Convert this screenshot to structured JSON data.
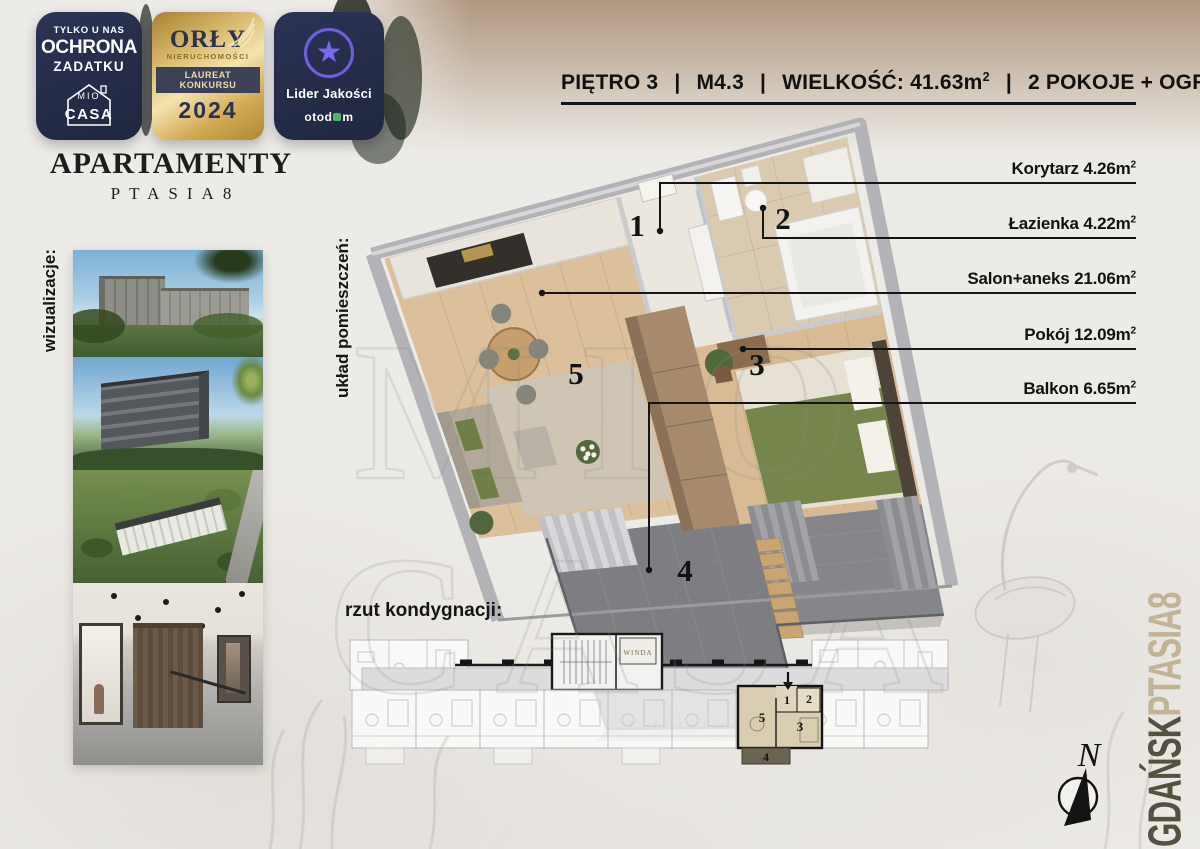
{
  "badges": {
    "protection": {
      "line1": "TYLKO U NAS",
      "line2": "OCHRONA",
      "line3": "ZADATKU",
      "logo_mio": "MIO",
      "logo_casa": "CASA"
    },
    "orly": {
      "name": "ORŁY",
      "category": "NIERUCHOMOŚCI",
      "award": "LAUREAT KONKURSU",
      "year": "2024"
    },
    "otodom": {
      "award": "Lider Jakości",
      "brand_start": "otod",
      "brand_end": "m",
      "star": "★"
    }
  },
  "brand": {
    "name": "APARTAMENTY",
    "project": "PTASIA8"
  },
  "section_labels": {
    "visualizations": "wizualizacje:",
    "room_layout": "układ pomieszczeń:",
    "floor_plan": "rzut kondygnacji:"
  },
  "header": {
    "floor": "PIĘTRO 3",
    "unit": "M4.3",
    "size": "WIELKOŚĆ: 41.63m",
    "size_sup": "2",
    "rooms": "2 POKOJE + OGRÓD",
    "divider": "|"
  },
  "rooms": [
    {
      "number": "1",
      "label": "Korytarz 4.26m",
      "sup": "2"
    },
    {
      "number": "2",
      "label": "Łazienka 4.22m",
      "sup": "2"
    },
    {
      "number": "5",
      "label": "Salon+aneks 21.06m",
      "sup": "2"
    },
    {
      "number": "3",
      "label": "Pokój 12.09m",
      "sup": "2"
    },
    {
      "number": "4",
      "label": "Balkon 6.65m",
      "sup": "2"
    }
  ],
  "plan3d": {
    "numbers": [
      "1",
      "2",
      "3",
      "4",
      "5"
    ]
  },
  "floor_strip": {
    "elevator": "WINDA",
    "unit_numbers": {
      "n1": "1",
      "n2": "2",
      "n3": "3",
      "n4": "4",
      "n5": "5"
    }
  },
  "location": {
    "city": "GDAŃSK",
    "project": "PTASIA8"
  },
  "compass": {
    "north": "N"
  },
  "watermark": {
    "line1": "MIO",
    "line2": "CASA"
  },
  "colors": {
    "navy": "#252e4c",
    "gold": "#c9a14e",
    "purple": "#7b68ee",
    "otodom_green": "#4db56a",
    "highlight_unit": "#d9cdb2",
    "balcony_olive": "#6b6453",
    "city_text": "#55503f",
    "project_text": "#c2b298"
  }
}
